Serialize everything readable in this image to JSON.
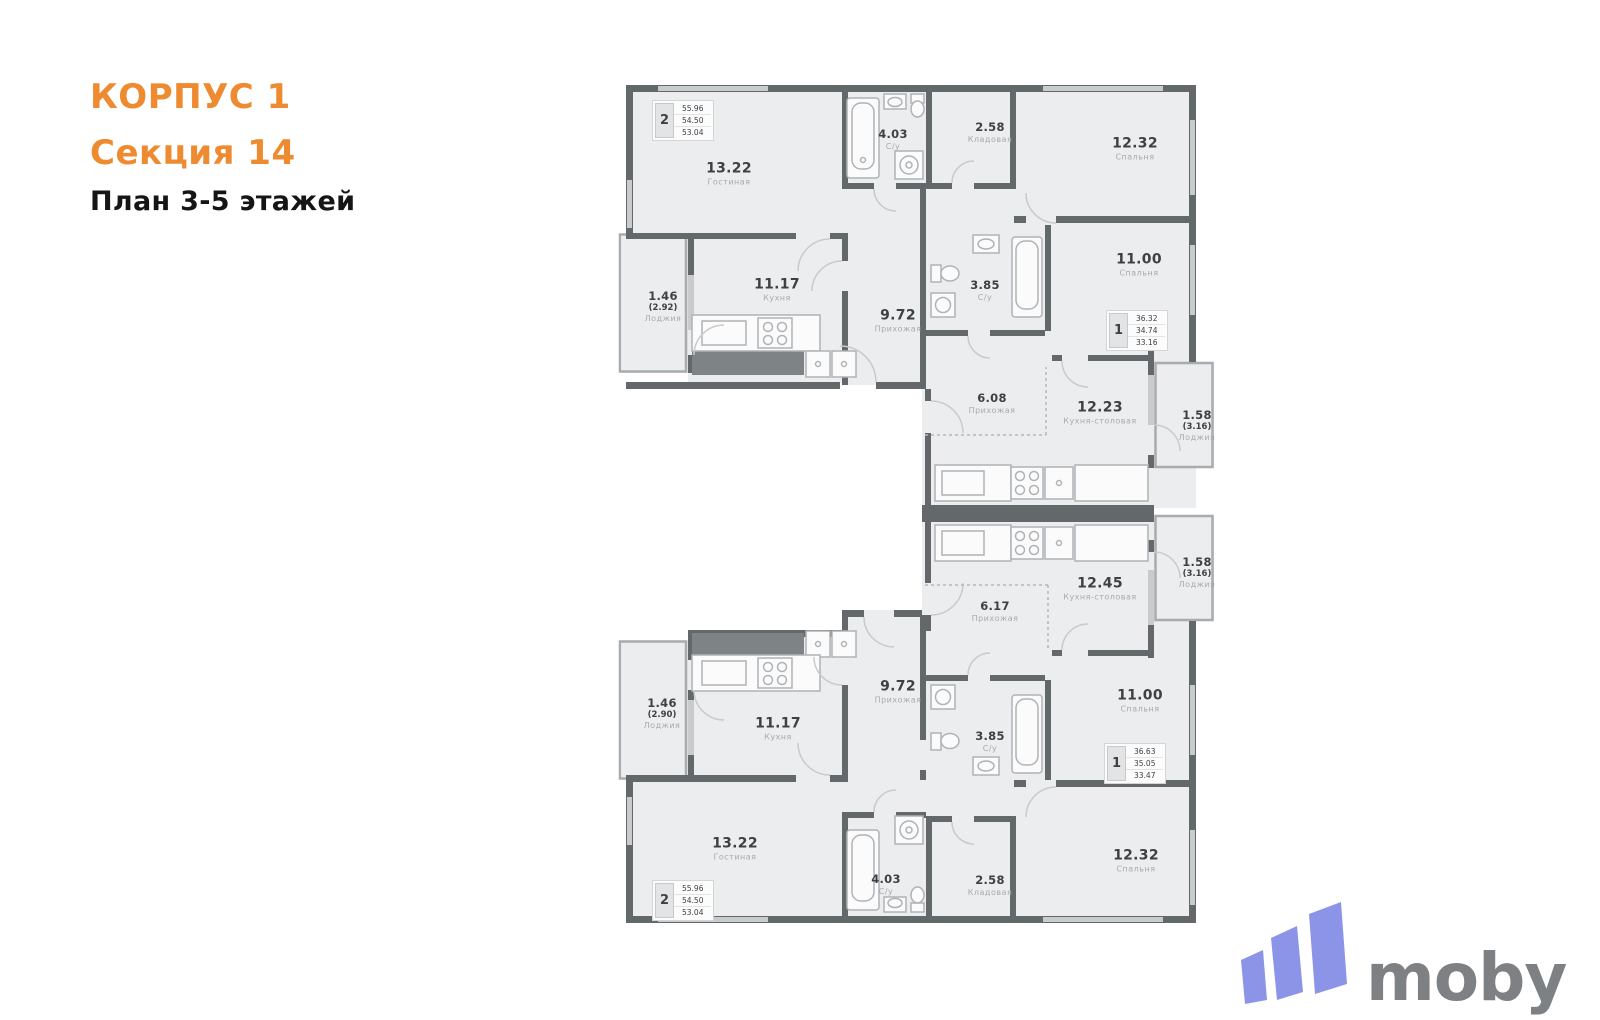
{
  "header": {
    "building": "КОРПУС 1",
    "section": "Секция 14",
    "plan": "План 3-5 этажей"
  },
  "apartments": {
    "top_left": {
      "badge": "2",
      "areas": [
        "55.96",
        "54.50",
        "53.04"
      ]
    },
    "top_right": {
      "badge": "1",
      "areas": [
        "36.32",
        "34.74",
        "33.16"
      ]
    },
    "bottom_right": {
      "badge": "1",
      "areas": [
        "36.63",
        "35.05",
        "33.47"
      ]
    },
    "bottom_left": {
      "badge": "2",
      "areas": [
        "55.96",
        "54.50",
        "53.04"
      ]
    }
  },
  "rooms": {
    "t_living": {
      "area": "13.22",
      "name": "Гостиная"
    },
    "t_su": {
      "area": "4.03",
      "name": "С/у"
    },
    "t_storage": {
      "area": "2.58",
      "name": "Кладовая"
    },
    "t_bedroom": {
      "area": "12.32",
      "name": "Спальня"
    },
    "t_loggia": {
      "area": "1.46",
      "extra": "(2.92)",
      "name": "Лоджия"
    },
    "t_kitchen": {
      "area": "11.17",
      "name": "Кухня"
    },
    "t_hall": {
      "area": "9.72",
      "name": "Прихожая"
    },
    "tr_su": {
      "area": "3.85",
      "name": "С/у"
    },
    "tr_bedroom": {
      "area": "11.00",
      "name": "Спальня"
    },
    "tr_hall": {
      "area": "6.08",
      "name": "Прихожая"
    },
    "tr_kitchen": {
      "area": "12.23",
      "name": "Кухня-столовая"
    },
    "tr_loggia": {
      "area": "1.58",
      "extra": "(3.16)",
      "name": "Лоджия"
    },
    "br_loggia": {
      "area": "1.58",
      "extra": "(3.16)",
      "name": "Лоджия"
    },
    "br_kitchen": {
      "area": "12.45",
      "name": "Кухня-столовая"
    },
    "br_hall": {
      "area": "6.17",
      "name": "Прихожая"
    },
    "br_su": {
      "area": "3.85",
      "name": "С/у"
    },
    "br_bedroom": {
      "area": "11.00",
      "name": "Спальня"
    },
    "b_loggia": {
      "area": "1.46",
      "extra": "(2.90)",
      "name": "Лоджия"
    },
    "b_kitchen": {
      "area": "11.17",
      "name": "Кухня"
    },
    "b_hall": {
      "area": "9.72",
      "name": "Прихожая"
    },
    "b_living": {
      "area": "13.22",
      "name": "Гостиная"
    },
    "b_su": {
      "area": "4.03",
      "name": "С/у"
    },
    "b_storage": {
      "area": "2.58",
      "name": "Кладовая"
    },
    "b_bedroom": {
      "area": "12.32",
      "name": "Спальня"
    }
  },
  "logo": {
    "text": "moby"
  },
  "colors": {
    "accent": "#EE8A30",
    "wall": "#63686B",
    "room_fill": "#ECEDEE",
    "logo_bars": "#8C94E8",
    "logo_text": "#7D8184"
  }
}
